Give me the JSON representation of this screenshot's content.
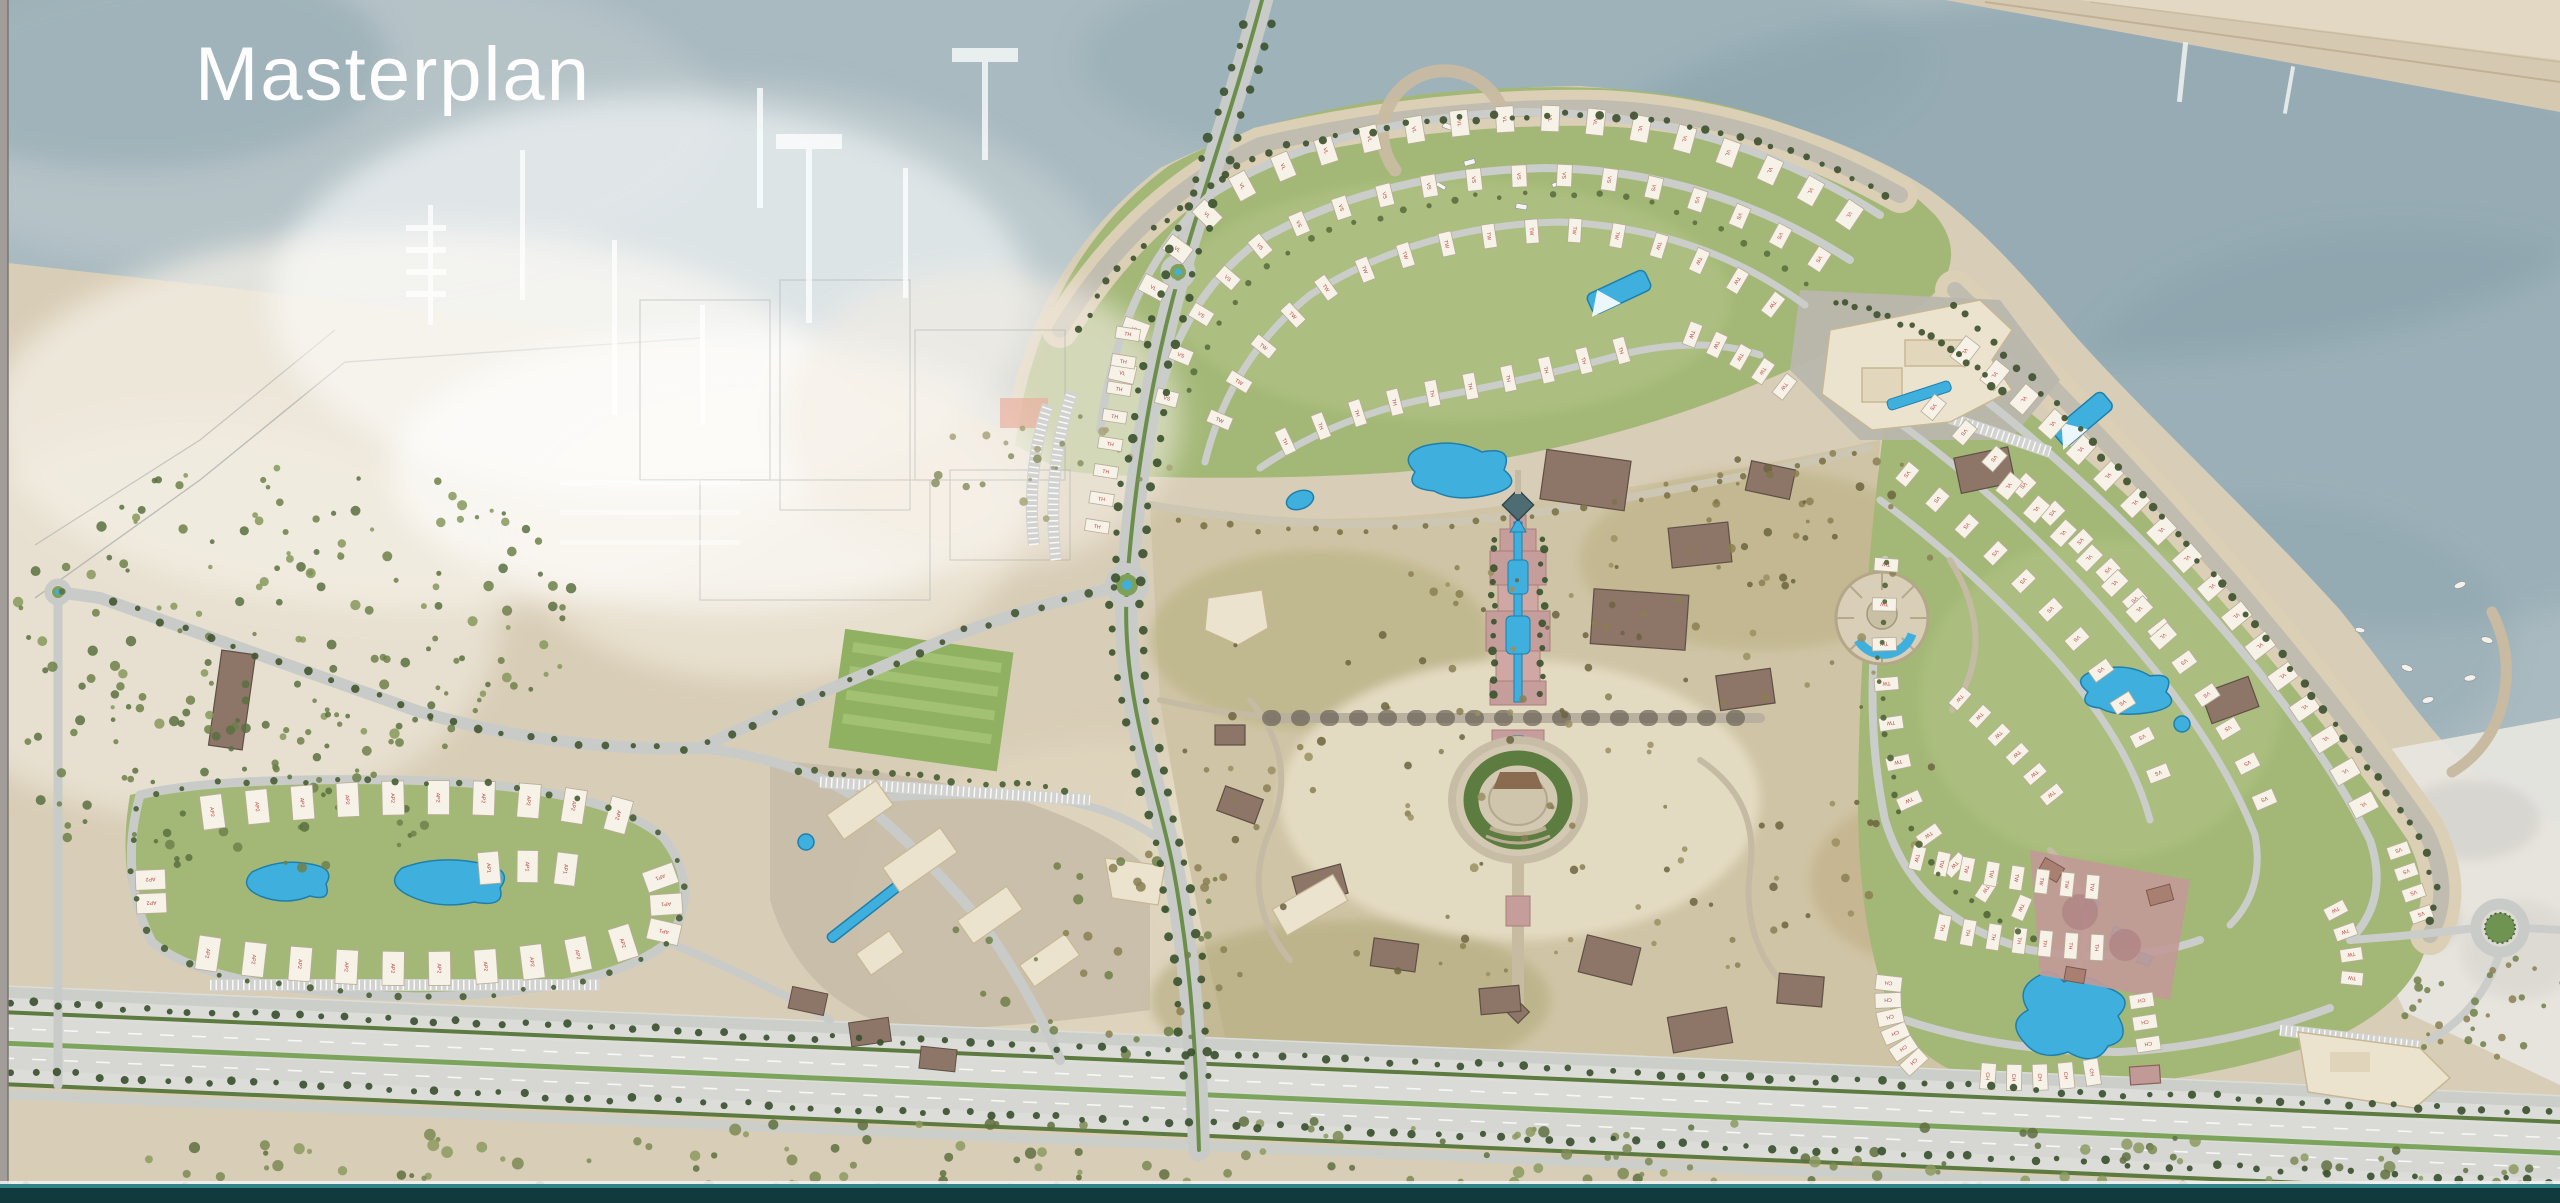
{
  "slide": {
    "title": "Masterplan"
  },
  "map": {
    "areas": [
      "marina",
      "north-village",
      "east-village",
      "west-apartments",
      "central-park",
      "grand-water-axis",
      "amphitheater",
      "commercial-hub",
      "beach-promenade",
      "highway",
      "desert-scrub",
      "opposite-shore"
    ],
    "unit_type_codes": [
      "VL",
      "VS",
      "TW",
      "TH",
      "CH",
      "AP1",
      "AP2"
    ],
    "colors": {
      "water": "#a9bac0",
      "waterDeep": "#849ca6",
      "waterLight": "#cdd7d9",
      "sand": "#d8cdb6",
      "sandLight": "#e9e0cd",
      "beachPave": "#c0bcb0",
      "lawn": "#a3b877",
      "lawnLight": "#b7c78b",
      "scrub": "#6d8049",
      "road": "#c9cbc9",
      "roadLight": "#dadbd7",
      "stone": "#cbc2ac",
      "parkGround": "#cfc4a5",
      "olive": "#8a7f52",
      "pool": "#3fb0dd",
      "poolDeep": "#1e7fae",
      "roofWhite": "#f7f2e7",
      "roofLine": "#b7ac98",
      "label": "#b5403c",
      "brown": "#8d7668",
      "brownDark": "#5f4f45",
      "cream": "#ece3cf",
      "creamLine": "#c7b794",
      "pink": "#c59d9a",
      "mauve": "#c19a98",
      "hedge": "#3d5430",
      "median": "#7da45c",
      "frameTeal": "#113a3e",
      "frameAqua": "#2f8589"
    },
    "house_rows": [
      {
        "id": "n1",
        "code": "VL",
        "path": "M 1118,395 Q 1140,265 1235,190 Q 1350,125 1530,118 Q 1720,120 1868,228",
        "count": 20,
        "w": 26,
        "h": 18
      },
      {
        "id": "n2",
        "code": "VS",
        "path": "M 1162,420 Q 1185,300 1275,235 Q 1390,178 1550,175 Q 1705,178 1838,272",
        "count": 18,
        "w": 22,
        "h": 15
      },
      {
        "id": "n3",
        "code": "TW",
        "path": "M 1212,440 Q 1245,345 1330,285 Q 1440,232 1565,230 Q 1690,235 1790,318",
        "count": 16,
        "w": 24,
        "h": 13
      },
      {
        "id": "n4",
        "code": "TH",
        "path": "M 1268,450 Q 1350,408 1450,390 Q 1550,372 1640,345",
        "count": 10,
        "w": 26,
        "h": 12
      },
      {
        "id": "n5",
        "code": "TW",
        "path": "M 1680,330 Q 1740,350 1795,395",
        "count": 5,
        "w": 24,
        "h": 13
      },
      {
        "id": "nw",
        "code": "TH",
        "path": "M 1095,540 L 1130,320",
        "count": 8,
        "w": 24,
        "h": 12
      },
      {
        "id": "e1",
        "code": "VL",
        "path": "M 1950,340 Q 2090,445 2215,590 Q 2320,715 2372,822",
        "count": 17,
        "w": 26,
        "h": 18
      },
      {
        "id": "e2",
        "code": "VS",
        "path": "M 1918,395 Q 2040,490 2148,615 Q 2235,722 2272,818",
        "count": 14,
        "w": 22,
        "h": 15
      },
      {
        "id": "e3",
        "code": "VS",
        "path": "M 1892,462 Q 1990,540 2078,640 Q 2142,720 2165,792",
        "count": 11,
        "w": 22,
        "h": 14
      },
      {
        "id": "e4",
        "code": "TW",
        "path": "M 1888,545 Q 1875,680 1905,790 Q 1940,880 2040,915",
        "count": 11,
        "w": 24,
        "h": 13
      },
      {
        "id": "e5",
        "code": "TW",
        "path": "M 1950,690 Q 2010,740 2060,805",
        "count": 6,
        "w": 22,
        "h": 12
      },
      {
        "id": "e6",
        "code": "VL",
        "path": "M 1995,475 Q 2090,550 2175,650",
        "count": 7,
        "w": 24,
        "h": 16
      },
      {
        "id": "se1",
        "code": "TW",
        "path": "M 1905,855 Q 2000,880 2105,888",
        "count": 8,
        "w": 24,
        "h": 13
      },
      {
        "id": "se2",
        "code": "TH",
        "path": "M 1930,925 Q 2020,945 2110,948",
        "count": 7,
        "w": 26,
        "h": 13
      },
      {
        "id": "ch1",
        "code": "CH",
        "path": "M 1890,975 Q 1880,1030 1920,1068",
        "count": 6,
        "w": 26,
        "h": 15
      },
      {
        "id": "ch2",
        "code": "CH",
        "path": "M 1975,1075 Q 2040,1082 2105,1070",
        "count": 5,
        "w": 26,
        "h": 15
      },
      {
        "id": "ch3",
        "code": "CH",
        "path": "M 2140,990 L 2150,1055",
        "count": 3,
        "w": 24,
        "h": 14
      },
      {
        "id": "er1",
        "code": "VS",
        "path": "M 2395,840 L 2425,925",
        "count": 4,
        "w": 22,
        "h": 13
      },
      {
        "id": "er2",
        "code": "TW",
        "path": "M 2330,900 Q 2360,950 2350,990",
        "count": 4,
        "w": 22,
        "h": 13
      },
      {
        "id": "w1",
        "code": "AP2",
        "path": "M 190,815 Q 330,795 470,798 Q 580,800 640,822",
        "count": 10,
        "w": 34,
        "h": 22
      },
      {
        "id": "w2",
        "code": "AP2",
        "path": "M 185,950 Q 320,972 460,968 Q 580,962 645,935",
        "count": 10,
        "w": 34,
        "h": 22
      },
      {
        "id": "w3",
        "code": "AP1",
        "path": "M 470,870 Q 530,862 585,872",
        "count": 3,
        "w": 32,
        "h": 21
      },
      {
        "id": "w4",
        "code": "AP1",
        "path": "M 655,865 Q 675,905 660,945",
        "count": 3,
        "w": 32,
        "h": 21
      },
      {
        "id": "w5",
        "code": "AP2",
        "path": "M 150,868 L 152,915",
        "count": 2,
        "w": 30,
        "h": 20
      }
    ],
    "tree_lines": [
      {
        "id": "blvd-left",
        "path": "M 1248,10 C 1221,100 1191,185 1166,272 C 1141,360 1121,470 1113,585 C 1106,690 1141,780 1158,862 C 1174,945 1181,1020 1185,1090",
        "count": 46,
        "r": 4,
        "color": "#3d5430",
        "seed": 3
      },
      {
        "id": "blvd-right",
        "path": "M 1276,10 C 1249,100 1219,185 1194,272 C 1169,360 1149,470 1141,585 C 1134,690 1169,780 1186,862 C 1202,945 1209,1020 1211,1090",
        "count": 46,
        "r": 4,
        "color": "#3d5430",
        "seed": 4
      },
      {
        "id": "north-promenade",
        "path": "M 1075,335 Q 1150,205 1270,150 Q 1430,112 1600,115 Q 1755,122 1892,200",
        "count": 52,
        "r": 3.5,
        "color": "#3f5230",
        "seed": 5
      },
      {
        "id": "east-promenade",
        "path": "M 1948,298 Q 2085,428 2225,588 Q 2345,728 2418,838 Q 2448,892 2425,930",
        "count": 46,
        "r": 3.5,
        "color": "#3f5230",
        "seed": 6
      },
      {
        "id": "highway-upper",
        "path": "M 0,1002 L 2560,1112",
        "count": 115,
        "r": 3.5,
        "color": "#3a5130",
        "seed": 7
      },
      {
        "id": "highway-lower",
        "path": "M 0,1072 L 2560,1182",
        "count": 115,
        "r": 3.5,
        "color": "#3a5130",
        "seed": 8
      },
      {
        "id": "shore-road-west",
        "path": "M 1127,585 Q 1000,612 898,660 Q 798,702 700,748 Q 560,752 420,712 Q 260,655 100,598",
        "count": 42,
        "r": 3.5,
        "color": "#445833",
        "seed": 9
      },
      {
        "id": "west-ring",
        "path": "M 140,795 Q 118,875 152,942 Q 210,992 420,997 Q 608,992 668,942 Q 703,888 663,837 Q 600,784 400,780 Q 212,777 140,795",
        "count": 44,
        "r": 3,
        "color": "#4a6036",
        "seed": 10
      },
      {
        "id": "park-north-loop",
        "path": "M 1165,520 Q 1360,545 1540,515 Q 1730,485 1865,450",
        "count": 26,
        "r": 3,
        "color": "#7e7448",
        "seed": 11
      },
      {
        "id": "east-inner-ring",
        "path": "M 1888,555 Q 1868,690 1898,805 Q 1935,905 2045,942",
        "count": 24,
        "r": 3,
        "color": "#54663a",
        "seed": 12
      },
      {
        "id": "north-mid-arc",
        "path": "M 1186,405 Q 1210,300 1300,245 Q 1410,195 1558,192 Q 1698,196 1815,290",
        "count": 30,
        "r": 3,
        "color": "#5b7140",
        "seed": 13
      },
      {
        "id": "axis-left",
        "path": "M 1494,530 L 1494,700",
        "count": 12,
        "r": 3.5,
        "color": "#3d5430",
        "seed": 14
      },
      {
        "id": "axis-right",
        "path": "M 1542,530 L 1542,700",
        "count": 12,
        "r": 3.5,
        "color": "#3d5430",
        "seed": 15
      },
      {
        "id": "ne-hotel-beach",
        "path": "M 1830,300 Q 1930,320 2005,395",
        "count": 18,
        "r": 3.5,
        "color": "#3f5230",
        "seed": 16
      },
      {
        "id": "commercial-edge",
        "path": "M 790,770 Q 930,775 1070,790",
        "count": 18,
        "r": 3,
        "color": "#4a6036",
        "seed": 17
      }
    ],
    "scatter_regions": [
      {
        "id": "left-scrub",
        "cx": 300,
        "cy": 610,
        "rx": 290,
        "ry": 150,
        "count": 150,
        "r": 3.5,
        "colors": [
          "#6d8049",
          "#597040",
          "#86985c"
        ],
        "seed": 21
      },
      {
        "id": "left-scrub-low",
        "cx": 240,
        "cy": 780,
        "rx": 240,
        "ry": 95,
        "count": 80,
        "r": 3.5,
        "colors": [
          "#6d8049",
          "#597040"
        ],
        "seed": 22
      },
      {
        "id": "under-highway-scrub",
        "cx": 1280,
        "cy": 1175,
        "rx": 1280,
        "ry": 55,
        "count": 240,
        "r": 4,
        "colors": [
          "#7c8a55",
          "#5f7040",
          "#8c9a60"
        ],
        "seed": 23
      },
      {
        "id": "park-olive",
        "cx": 1560,
        "cy": 760,
        "rx": 390,
        "ry": 240,
        "count": 130,
        "r": 3,
        "colors": [
          "#8a7f52",
          "#6c6440",
          "#9a8f60"
        ],
        "seed": 24
      },
      {
        "id": "park-ne",
        "cx": 1800,
        "cy": 520,
        "rx": 170,
        "ry": 70,
        "count": 36,
        "r": 3,
        "colors": [
          "#8a7f52",
          "#6c6440"
        ],
        "seed": 25
      },
      {
        "id": "park-west-desert",
        "cx": 1100,
        "cy": 950,
        "rx": 160,
        "ry": 110,
        "count": 40,
        "r": 3.5,
        "colors": [
          "#8a7f52",
          "#6f8049"
        ],
        "seed": 26
      },
      {
        "id": "right-scrub",
        "cx": 2480,
        "cy": 1005,
        "rx": 90,
        "ry": 60,
        "count": 30,
        "r": 3,
        "colors": [
          "#8a7f52",
          "#6f8049"
        ],
        "seed": 27
      },
      {
        "id": "marina-beach",
        "cx": 1050,
        "cy": 470,
        "rx": 120,
        "ry": 60,
        "count": 25,
        "r": 3,
        "colors": [
          "#a8a37b",
          "#8a8f62"
        ],
        "seed": 28
      }
    ]
  }
}
